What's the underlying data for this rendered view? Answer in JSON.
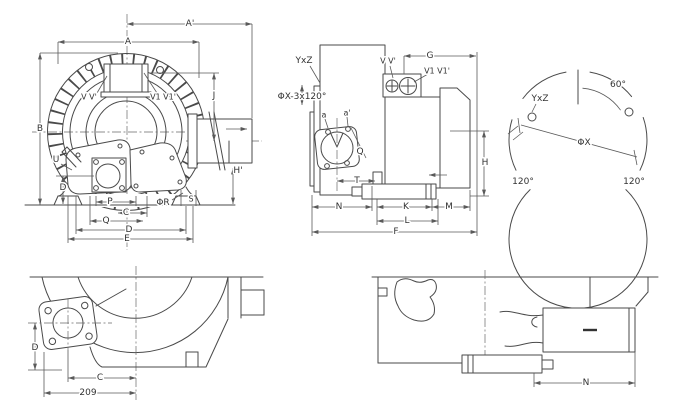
{
  "drawing": {
    "front_view": {
      "dim_a_prime": "A'",
      "dim_a": "A",
      "dim_b": "B",
      "dim_j": "J",
      "port_v": "V V'",
      "port_v1": "V1 V1'",
      "dim_u": "U",
      "dim_d_left": "D",
      "dim_p": "P",
      "dim_c": "C",
      "dim_q": "Q",
      "dim_d": "D",
      "dim_e": "E",
      "dim_phi_r": "ΦR",
      "dim_s": "S",
      "dim_h_prime": "H'"
    },
    "side_view": {
      "dim_yxz": "YxZ",
      "dim_phix_pattern": "ΦX-3x120°",
      "port_v": "V V'",
      "port_v1": "V1 V1'",
      "dim_g": "G",
      "hole_a": "a",
      "hole_a_prime": "a'",
      "dim_q": "Q",
      "dim_t": "T",
      "dim_h": "H",
      "dim_n": "N",
      "dim_k": "K",
      "dim_m": "M",
      "dim_l": "L",
      "dim_f": "F"
    },
    "bolt_circle_view": {
      "angle_60": "60°",
      "dim_yxz": "YxZ",
      "dim_phix": "ΦX",
      "angle_120_left": "120°",
      "angle_120_right": "120°"
    },
    "bottom_left_view": {
      "dim_d": "D",
      "dim_c": "C",
      "dim_209": "209"
    },
    "bottom_right_view": {
      "dim_n": "N"
    }
  },
  "colors": {
    "line": "#4a4a4a",
    "label": "#333333",
    "background": "#ffffff"
  }
}
